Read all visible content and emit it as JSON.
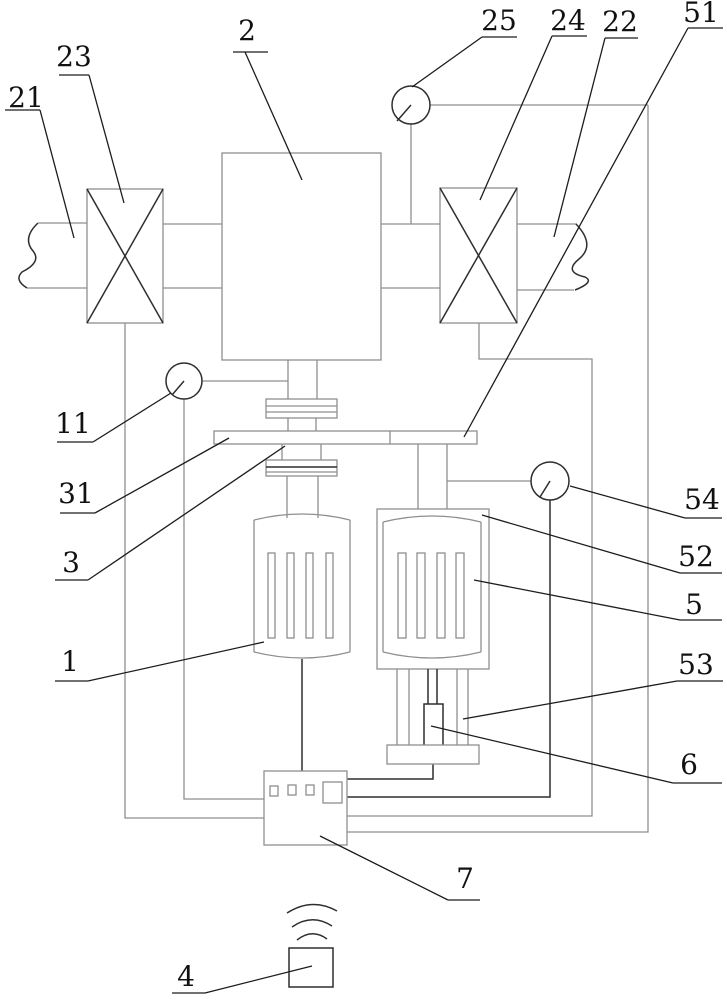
{
  "figure": {
    "kind": "patent-style schematic line drawing",
    "background_color": "#ffffff",
    "line_color_light": "#8f8f8f",
    "line_color_dark": "#2e2e2e",
    "reference_labels": {
      "1": "1",
      "2": "2",
      "3": "3",
      "4": "4",
      "5": "5",
      "6": "6",
      "7": "7",
      "11": "11",
      "21": "21",
      "22": "22",
      "23": "23",
      "24": "24",
      "25": "25",
      "31": "31",
      "51": "51",
      "52": "52",
      "53": "53",
      "54": "54"
    }
  }
}
